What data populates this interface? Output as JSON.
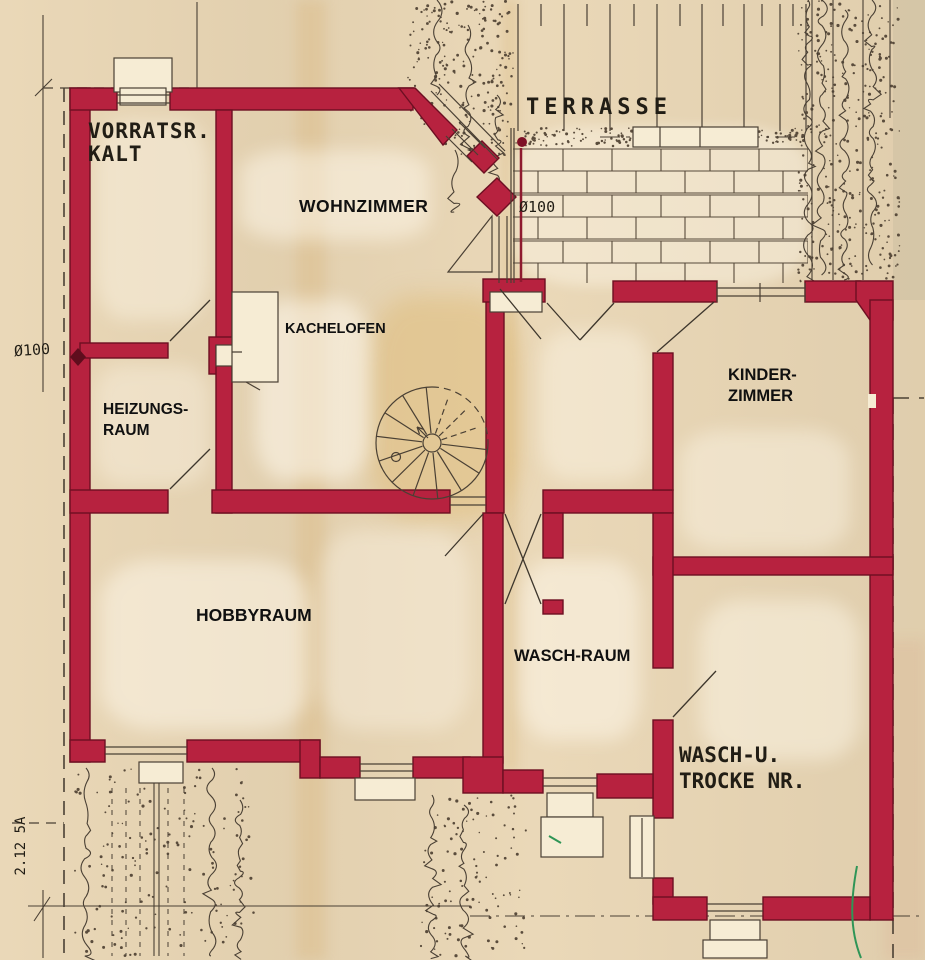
{
  "document": {
    "kind": "scanned floor plan"
  },
  "rooms": {
    "vorratsraum": {
      "line1": "VORRATSR.",
      "line2": "KALT"
    },
    "terrasse": {
      "label": "TERRASSE"
    },
    "wohnzimmer": {
      "label": "WOHNZIMMER"
    },
    "kachelofen": {
      "label": "KACHELOFEN"
    },
    "heizungsraum": {
      "line1": "HEIZUNGS-",
      "line2": "RAUM"
    },
    "hobbyraum": {
      "label": "HOBBYRAUM"
    },
    "waschraum": {
      "label": "WASCH-RAUM"
    },
    "kinderzimmer": {
      "line1": "KINDER-",
      "line2": "ZIMMER"
    },
    "waschtrockenraum": {
      "line1": "WASCH-U.",
      "line2": "TROCKE NR."
    }
  },
  "annotations": {
    "pipe_diameter_left": "Ø100",
    "pipe_diameter_terrace": "Ø100",
    "margin_note": "2.12  5A"
  },
  "colors": {
    "wall": "#b7223f",
    "wall_edge": "#6d0f22",
    "ink": "#4a4034",
    "paper": "#e9d6b4",
    "label_text": "#101010",
    "drafting_text": "#211d15",
    "green_mark": "#2f9556",
    "drain_red": "#8e1a2e"
  }
}
